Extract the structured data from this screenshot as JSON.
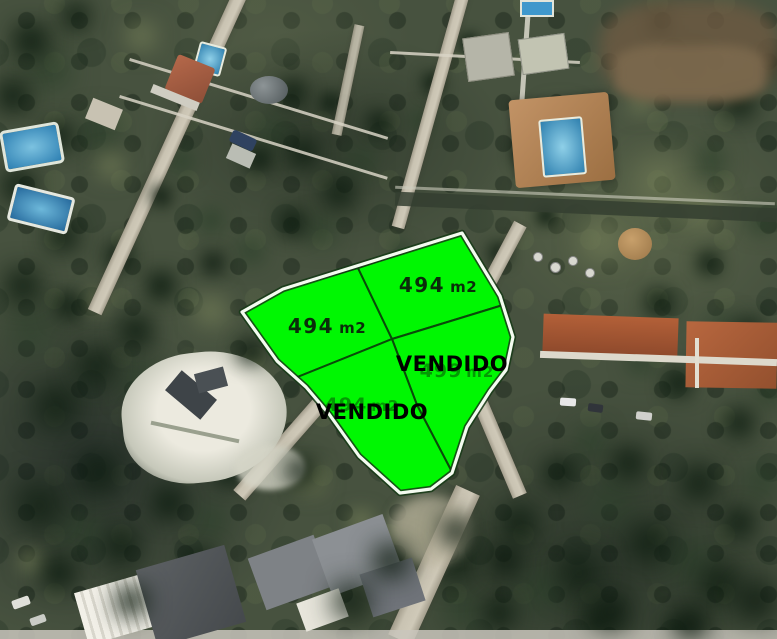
{
  "map_overlay": {
    "type": "aerial-parcel-map",
    "parcels": [
      {
        "position": "left",
        "area": "494",
        "unit": "m2",
        "status": "available"
      },
      {
        "position": "top-right",
        "area": "494",
        "unit": "m2",
        "status": "available"
      },
      {
        "position": "right",
        "area": "499",
        "unit": "m2",
        "status": "sold",
        "status_label": "VENDIDO"
      },
      {
        "position": "bottom",
        "area": "494",
        "unit": "m2",
        "status": "sold",
        "status_label": "VENDIDO"
      }
    ],
    "colors": {
      "parcel_fill": "#00f702",
      "parcel_border": "#f4fbf0",
      "division_line": "#0a4a0a",
      "area_text": "#0a2d0a",
      "sold_text": "#000000",
      "pool_blue": "#3d95c8",
      "roof_orange": "#b36038",
      "road_gray": "#c9c3b2"
    }
  }
}
